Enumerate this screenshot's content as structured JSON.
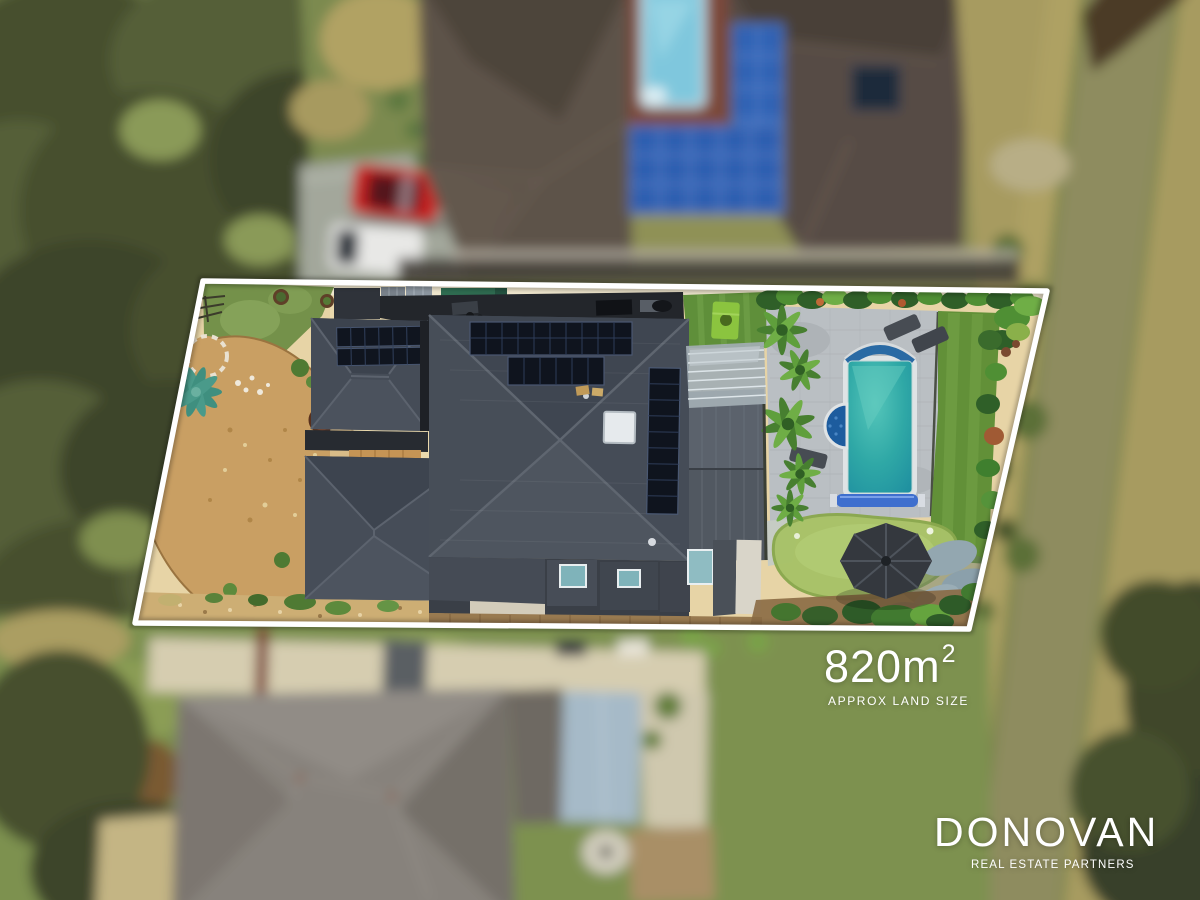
{
  "overlay": {
    "land_size": {
      "value": "820m",
      "exponent": "2",
      "label": "APPROX LAND SIZE"
    },
    "brand": {
      "name": "DONOVAN",
      "tagline": "REAL ESTATE PARTNERS"
    }
  },
  "scene": {
    "boundary_line_color": "#ffffff",
    "overlay_text_color": "#ffffff",
    "colors": {
      "main_roof_charcoal": "#49505b",
      "solar_panel_dark": "#0f141e",
      "neighbor_solar_blue": "#2e62b4",
      "pool_water_teal": "#2fa8a6",
      "neighbor_pool_blue": "#7fc7dd",
      "spa_blue": "#1d5c9e",
      "driveway_cream": "#e7d4a6",
      "lawn_green": "#6f8f46",
      "putting_green": "#a8c268",
      "paving_grey": "#babfc3",
      "dry_grass": "#a79b60",
      "mulch_tan": "#c99f63"
    }
  }
}
